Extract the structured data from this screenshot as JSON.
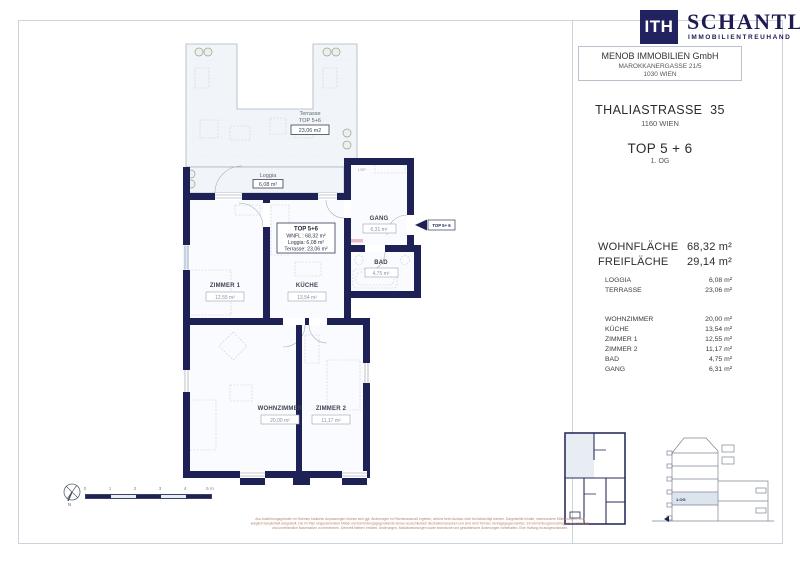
{
  "brand": {
    "logo_text": "ITH",
    "name": "SCHANTL",
    "tagline": "IMMOBILIENTREUHAND",
    "navy": "#232261"
  },
  "agency": {
    "name": "MENOB IMMOBILIEN GmbH",
    "address_line1": "MAROKKANERGASSE 21/5",
    "address_line2": "1030 WIEN"
  },
  "property": {
    "street": "THALIASTRASSE  35",
    "city": "1160 WIEN",
    "unit": "TOP 5 + 6",
    "floor": "1. OG"
  },
  "area_summary": {
    "primary": [
      {
        "label": "WOHNFLÄCHE",
        "value": "68,32 m²"
      },
      {
        "label": "FREIFLÄCHE",
        "value": "29,14 m²"
      }
    ],
    "outdoor": [
      {
        "label": "LOGGIA",
        "value": "6,08 m²"
      },
      {
        "label": "TERRASSE",
        "value": "23,06 m²"
      }
    ],
    "rooms": [
      {
        "label": "WOHNZIMMER",
        "value": "20,00 m²"
      },
      {
        "label": "KÜCHE",
        "value": "13,54 m²"
      },
      {
        "label": "ZIMMER 1",
        "value": "12,55 m²"
      },
      {
        "label": "ZIMMER 2",
        "value": "11,17 m²"
      },
      {
        "label": "BAD",
        "value": "4,75 m²"
      },
      {
        "label": "GANG",
        "value": "6,31 m²"
      }
    ]
  },
  "floor_plan": {
    "terrace": {
      "name": "Terrasse",
      "unit": "TOP 5+6",
      "area": "23,06 m2"
    },
    "loggia": {
      "name": "Loggia",
      "area": "6,08 m²"
    },
    "info_box": {
      "title": "TOP 5+6",
      "wnfl": "WNFL : 68,32 m²",
      "loggia": "Loggia: 6,08 m²",
      "terrace": "Terrasse: 23,06 m²"
    },
    "rooms": {
      "zimmer1": {
        "name": "ZIMMER 1",
        "area": "12,55 m²"
      },
      "kueche": {
        "name": "KÜCHE",
        "area": "13,54 m²"
      },
      "gang": {
        "name": "GANG",
        "area": "6,31 m²"
      },
      "bad": {
        "name": "BAD",
        "area": "4,75 m²"
      },
      "wohnzimmer": {
        "name": "WOHNZIMMER",
        "area": "20,00 m²"
      },
      "zimmer2": {
        "name": "ZIMMER 2",
        "area": "11,17 m²"
      }
    },
    "closet_label": "LRP",
    "entry_label": "TOP 5+ 6",
    "wall_color": "#1e2155"
  },
  "mini_diagrams": {
    "section_floor_label": "1.OG"
  },
  "scale_bar": {
    "ticks": [
      "0",
      "1",
      "2",
      "3",
      "4",
      "5 m"
    ]
  },
  "compass": {
    "north_label": "N"
  },
  "footer": {
    "disclaimer_lines": [
      "Aus Ausführungsgründen im Rahmen baulicher Anpassungen können sich ggf. Änderungen im Flächenausmaß ergeben, welche beim Ausbau nicht berücksichtigt werden. Dargestellte Inhalte, insbesondere Möblierungen, sind",
      "lediglich beispielhaft dargestellt. Die im Plan eingezeichneten Möbel und Einrichtungsgegenstände dienen ausschließlich Illustrationszwecken und sind nicht Teil des Vertragsgegenstandes. Ein Einrichtungsvorschlag ist unverbindlich",
      "und unverbindlich Naturmaßen zu entnehmen. Generell bleiben Irrtümer, Änderungen, Maßabweichungen sowie technische und gestalterische Änderungen vorbehalten. Eine Haftung ist ausgeschlossen."
    ],
    "color": "#b5826e"
  }
}
